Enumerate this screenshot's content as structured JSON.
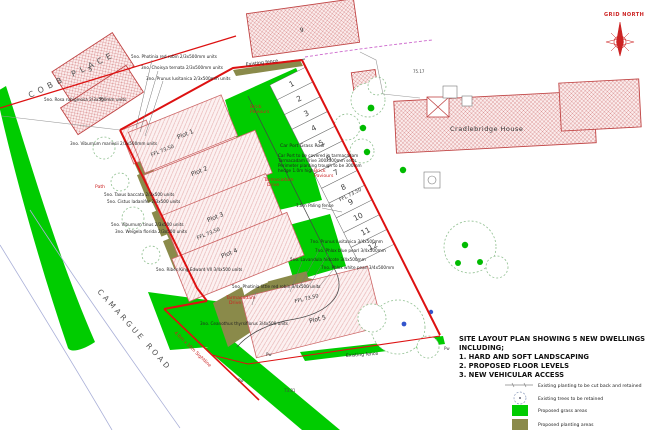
{
  "title": {
    "lines": [
      "SITE LAYOUT PLAN SHOWING 5 NEW DWELLINGS",
      "INCLUDING;",
      "1. HARD AND SOFT LANDSCAPING",
      "2. PROPOSED FLOOR LEVELS",
      "3. NEW VEHICULAR ACCESS"
    ]
  },
  "legend": {
    "items": [
      {
        "label": "Existing planting to be cut back and retained"
      },
      {
        "label": "Existing trees to be retained"
      },
      {
        "label": "Proposed grass areas"
      },
      {
        "label": "Proposed planting areas"
      }
    ]
  },
  "streets": {
    "cobb": "COBB PLACE",
    "camargue": "CAMARGUE ROAD"
  },
  "compass": {
    "label": "GRID NORTH"
  },
  "buildings": {
    "cradlebridge": "Cradlebridge House",
    "b3": "3",
    "b5": "5",
    "b9": "9"
  },
  "plots": [
    {
      "name": "Plot 1"
    },
    {
      "name": "Plot 2"
    },
    {
      "name": "Plot 3"
    },
    {
      "name": "Plot 4"
    },
    {
      "name": "Plot 5"
    }
  ],
  "ffl": "FFL 73.50",
  "parking": {
    "bays": [
      "1",
      "2",
      "3",
      "4",
      "5",
      "6",
      "7",
      "8",
      "9",
      "10",
      "11",
      "12"
    ]
  },
  "labels": {
    "existing_fence": "Existing fence",
    "sightline": "4.0m x 10m Sightline",
    "path": "Path",
    "tarmacadam": "Tarmacadam",
    "drive": "Drive",
    "brick": "Brick",
    "paviours": "Paviours",
    "carport_roof": "Car Port Grass Roof",
    "paling": "1.8m Paling fence"
  },
  "notes": [
    "5no. Photinia red robin 2/3x500mm units",
    "3no. Choisya ternata 2/3x500mm units",
    "3no. Prunus lusitanica 2/3x500mm units",
    "5no. Rosa rubiginosa 2/3x500mm units",
    "3no. Viburnum mariesii 2/3x500mm units",
    "5no. Taxus baccata 2/3x500 units",
    "5no. Cistus ladanifer 2/3x500 units",
    "5no. Viburnum tinus 2/3x500 units",
    "3no. Weigela florida 2/3x500 units",
    "5no. Ribes King Edward VII 3/4x500 units",
    "Car Port to be covered in tarmacadam",
    "Tarmacadam drive 300x300mm setts",
    "Perimeter planting trough to be 300mm",
    "hedge 1.0m high",
    "7no. Prunus lusitanica 3/4x500mm",
    "7no. Phlox blue pearl 3/4x500mm",
    "5no. Lavandula hidcote 3/4x500mm",
    "7no. Phlox white pearl 3/4x500mm",
    "5no. Photinia little red robin 3/4x500 units",
    "3no. Ceanothus thyrsiflorus 3/4x500 units"
  ],
  "levels": {
    "l1": "75.17",
    "l2": "73.81",
    "p": "Pw"
  },
  "colors": {
    "grass": "#00cc00",
    "planting": "#8a8a4a",
    "boundary_red": "#dd1111",
    "existing_hatch": "#d98f8f",
    "proposed_hatch": "#e5aaaa"
  }
}
